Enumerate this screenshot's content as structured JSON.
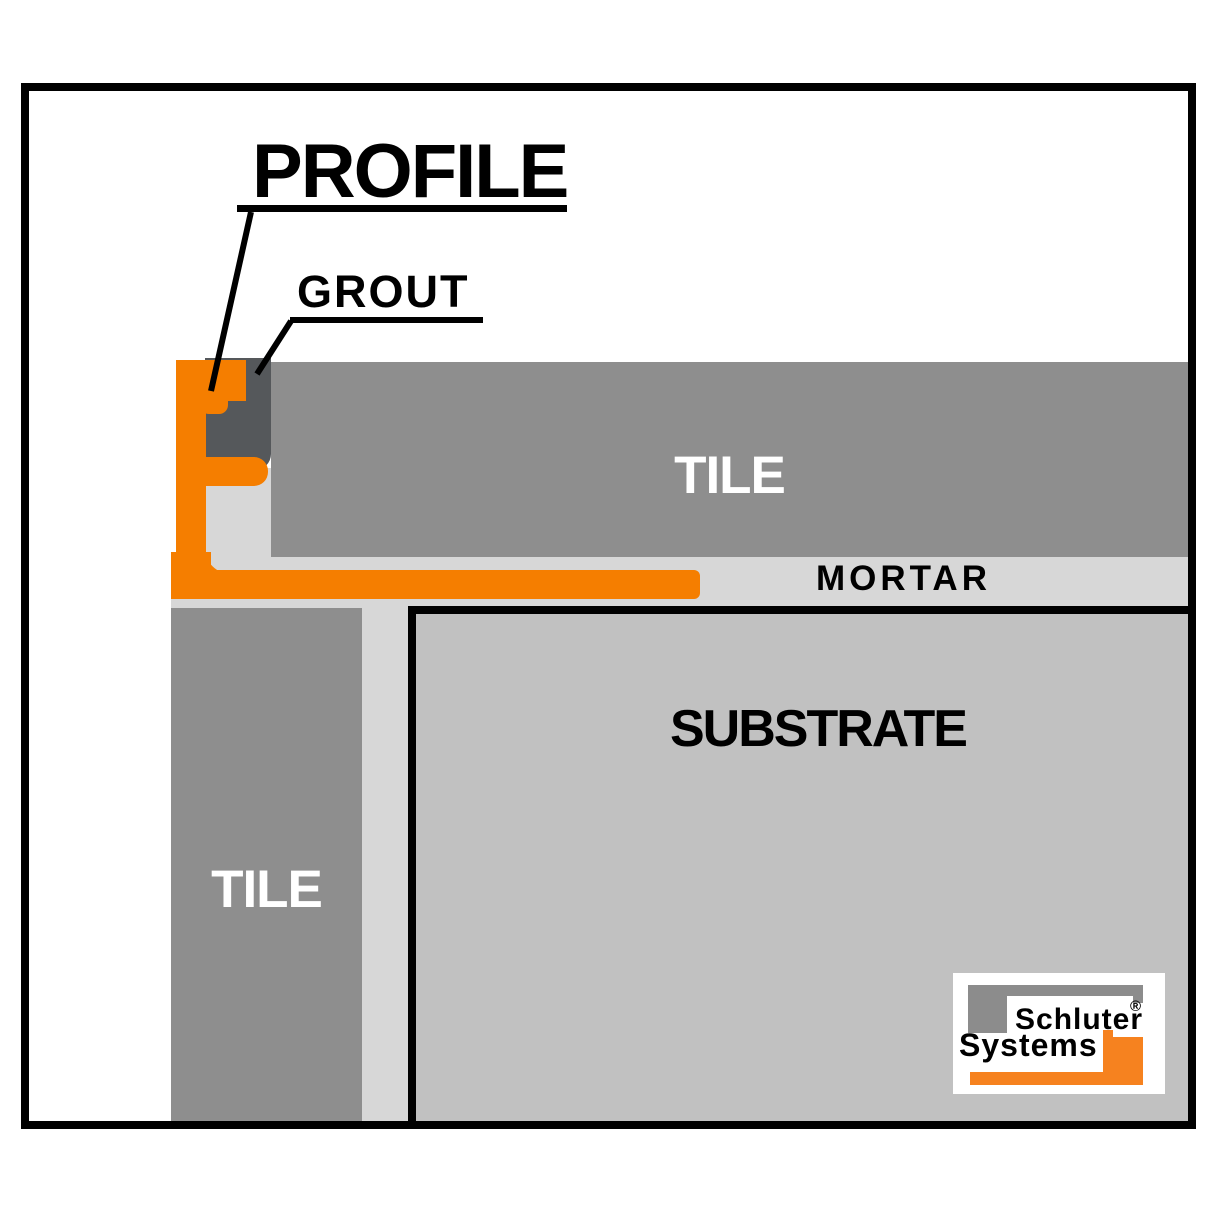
{
  "diagram": {
    "callouts": {
      "profile": "PROFILE",
      "grout": "GROUT"
    },
    "layers": {
      "tile_top": "TILE",
      "mortar": "MORTAR",
      "substrate": "SUBSTRATE",
      "tile_left": "TILE"
    }
  },
  "logo": {
    "line1": "Schluter",
    "line2": "Systems",
    "registered": "®"
  },
  "colors": {
    "background": "#FFFFFF",
    "frame_black": "#000000",
    "label_black": "#000000",
    "label_white": "#FFFFFF",
    "profile_orange": "#F57E00",
    "grout_dark": "#55585B",
    "tile_gray": "#8E8E8E",
    "mortar_light": "#D7D7D7",
    "substrate_gray": "#C1C1C1",
    "logo_gray": "#8C8C8C",
    "logo_orange": "#F6821F"
  }
}
